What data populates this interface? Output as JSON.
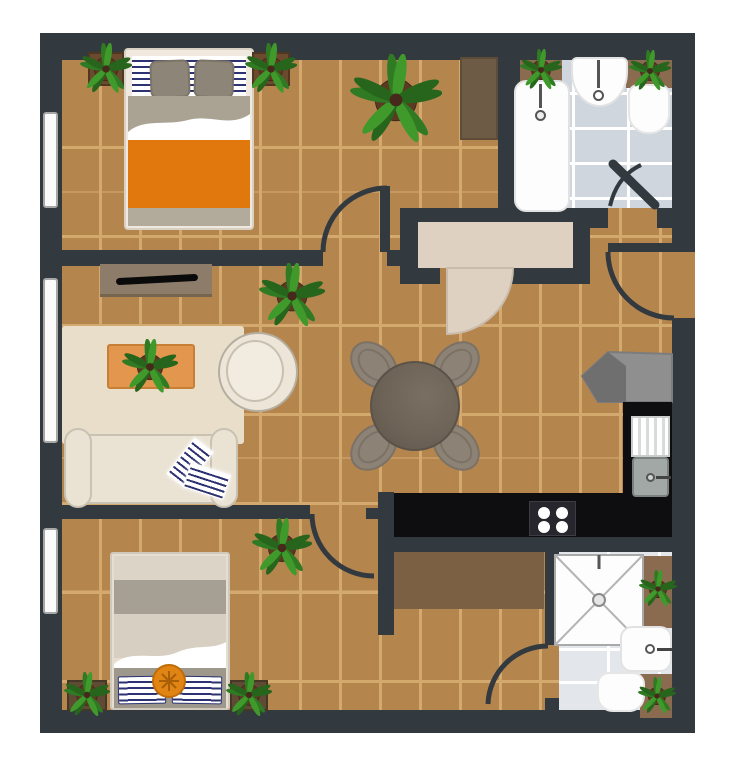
{
  "scene": {
    "kind": "apartment-floor-plan-top-down-illustration",
    "aria_label": "Apartment floor plan with two bedrooms, two bathrooms, living room, hall with dining table and kitchen",
    "canvas": {
      "width": 737,
      "height": 768
    }
  },
  "palette": {
    "wall": "#333a3f",
    "wood_floor": "#b5854e",
    "wood_seam": "#d3a96e",
    "tile_bath_top": "#cfd6de",
    "tile_bath_bottom": "#e3e6ea",
    "closet_interior": "#ded1c2",
    "rug_living": "#e8dec9",
    "rug_hall": "#7b6044",
    "counter_black": "#0e0e10",
    "orange_blanket": "#e0780e",
    "orange_cushion": "#e08414",
    "coffee_table_orange": "#e2964e",
    "navy_stripe": "#2c3272",
    "sofa_cream": "#eae3d4",
    "bed_gray": "#a5a093",
    "leaf_green_dark": "#2f7a22",
    "leaf_green_light": "#3f9a2b",
    "pot_brown": "#5b3a22",
    "shelf_brown": "#8a6b4f",
    "wardrobe_brown": "#6d5b45",
    "table_taupe": "#6e6357",
    "chair_taupe": "#8c8276"
  },
  "rooms": {
    "bedroom1": {
      "name": "Bedroom (top left)",
      "furniture": [
        "double bed with orange blanket, navy striped sheet and two gray pillows",
        "plant stand left of headboard",
        "plant stand right of headboard",
        "large floor plant",
        "dark brown wardrobe"
      ]
    },
    "bathroom1": {
      "name": "Bathroom (top right)",
      "furniture": [
        "bathtub with faucet",
        "wash basin",
        "toilet",
        "two shelf plants",
        "gray brick tile floor",
        "inward swinging door"
      ]
    },
    "living_room": {
      "name": "Living room (middle left)",
      "furniture": [
        "tv sideboard with black tv",
        "beige area rug",
        "orange coffee table with potted plant",
        "round cream armchair",
        "cream sofa with navy striped throw",
        "corner plant"
      ]
    },
    "hall": {
      "name": "Hall and dining (center)",
      "furniture": [
        "built-in closet with beige swing door",
        "round taupe dining table",
        "four oval chairs",
        "entrance door on right wall"
      ]
    },
    "kitchen": {
      "name": "Kitchen (right)",
      "furniture": [
        "L-shaped black counter",
        "sink with drainboard and faucet",
        "four-burner cooktop",
        "gray refrigerator",
        "brown runner rug"
      ]
    },
    "bedroom2": {
      "name": "Bedroom (bottom left)",
      "furniture": [
        "bed with striped pillows and orange round cushion",
        "two potted plants at headboard",
        "corner plant near door"
      ]
    },
    "bathroom2": {
      "name": "Bathroom (bottom right)",
      "furniture": [
        "square shower with cross pattern and drain",
        "wash basin",
        "toilet",
        "two shelf plants",
        "door to hall"
      ]
    }
  },
  "openings": {
    "windows_left_wall": 3,
    "doors": [
      "bedroom1-door",
      "bedroom2-door",
      "bathroom1-door",
      "bathroom2-door",
      "closet-door",
      "apartment-entrance-right-wall"
    ]
  },
  "plants": [
    {
      "x": 106,
      "y": 69,
      "r": 26,
      "stand": {
        "w": 36,
        "h": 34,
        "color": "#6b4a2e"
      }
    },
    {
      "x": 271,
      "y": 69,
      "r": 26,
      "stand": {
        "w": 38,
        "h": 34,
        "color": "#6b4a2e"
      }
    },
    {
      "x": 396,
      "y": 100,
      "r": 46,
      "stand": null
    },
    {
      "x": 541,
      "y": 70,
      "r": 21,
      "stand": null
    },
    {
      "x": 650,
      "y": 71,
      "r": 21,
      "stand": null
    },
    {
      "x": 292,
      "y": 296,
      "r": 33,
      "stand": null
    },
    {
      "x": 150,
      "y": 367,
      "r": 28,
      "stand": null
    },
    {
      "x": 282,
      "y": 548,
      "r": 30,
      "stand": null
    },
    {
      "x": 87,
      "y": 695,
      "r": 23,
      "stand": {
        "w": 40,
        "h": 31,
        "color": "#5f4a33"
      }
    },
    {
      "x": 249,
      "y": 695,
      "r": 23,
      "stand": {
        "w": 38,
        "h": 31,
        "color": "#5f4a33"
      }
    },
    {
      "x": 658,
      "y": 589,
      "r": 19,
      "stand": null
    },
    {
      "x": 657,
      "y": 696,
      "r": 19,
      "stand": null
    }
  ]
}
